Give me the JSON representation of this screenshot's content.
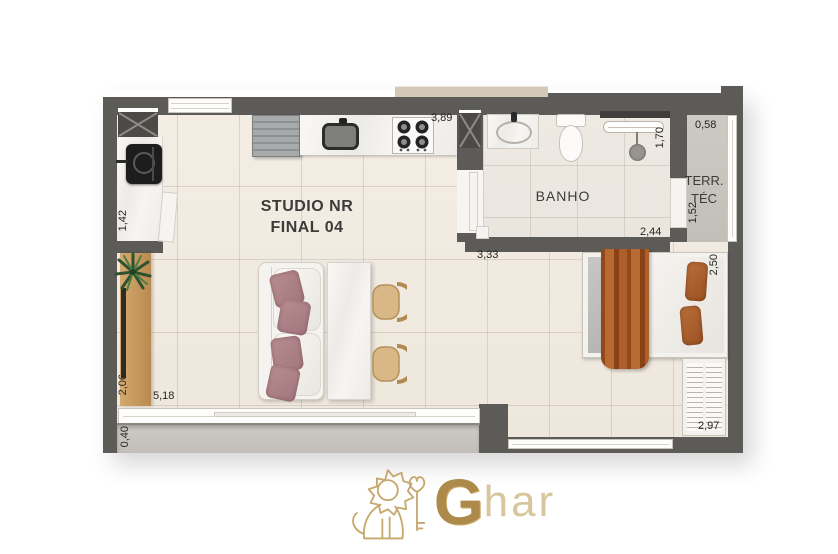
{
  "unit": {
    "name_line1": "STUDIO NR",
    "name_line2": "FINAL 04"
  },
  "rooms": {
    "bathroom": "BANHO",
    "tech_terrace_line1": "TERR.",
    "tech_terrace_line2": "TÉC"
  },
  "dimensions": {
    "kitchen_counter": "3,89",
    "laundry_depth": "1,42",
    "tech_terrace_width": "0,58",
    "shower_depth": "1,70",
    "bathroom_width": "2,44",
    "tech_terrace_depth": "1,52",
    "living_width": "3,33",
    "bed_area_depth": "2,50",
    "sideboard_length": "2,06",
    "balcony_width": "5,18",
    "balcony_depth": "0,40",
    "bedroom_wall": "2,97"
  },
  "logo": {
    "initial": "G",
    "rest": "har"
  },
  "colors": {
    "wall": "#5d5b58",
    "floor": "#f1ebe2",
    "concrete": "#c9c6c0",
    "wood": "#c79f63",
    "blanket": "#a9592a",
    "gold": "#bfa064"
  }
}
